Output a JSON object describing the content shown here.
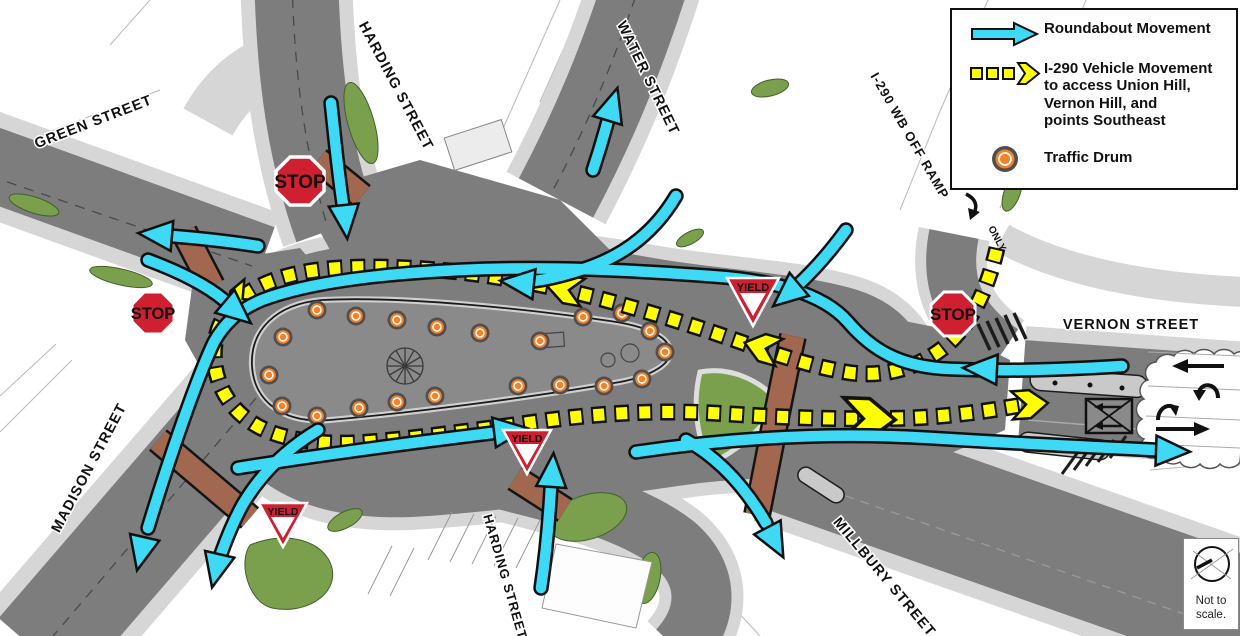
{
  "legend": {
    "items": [
      {
        "id": "roundabout-movement",
        "lines": [
          "Roundabout Movement"
        ]
      },
      {
        "id": "i290-movement",
        "lines": [
          "I-290 Vehicle Movement",
          "to access Union Hill,",
          "Vernon Hill, and",
          "points Southeast"
        ]
      },
      {
        "id": "traffic-drum",
        "lines": [
          "Traffic Drum"
        ]
      }
    ]
  },
  "street_labels": [
    {
      "id": "green-street",
      "text": "GREEN STREET"
    },
    {
      "id": "harding-street-top",
      "text": "HARDING STREET"
    },
    {
      "id": "water-street",
      "text": "WATER STREET"
    },
    {
      "id": "i290-wb-off-ramp",
      "text": "I-290 WB OFF RAMP"
    },
    {
      "id": "vernon-street",
      "text": "VERNON STREET"
    },
    {
      "id": "madison-street",
      "text": "MADISON STREET"
    },
    {
      "id": "harding-street-bottom",
      "text": "HARDING STREET"
    },
    {
      "id": "millbury-street",
      "text": "MILLBURY STREET"
    }
  ],
  "signs": {
    "stop_text": "STOP",
    "yield_text": "YIELD",
    "stop_count": 3,
    "yield_count": 3,
    "ramp_marking": "ONLY"
  },
  "note": {
    "lines": [
      "Not to",
      "scale."
    ]
  },
  "map": {
    "traffic_drum_count": 21
  },
  "colors": {
    "roundabout_arrow": "#3ED9F5",
    "i290_route_yellow": "#FFFF00",
    "traffic_drum_orange": "#F58025",
    "sign_red": "#CE2030",
    "road_gray": "#7D7D7D",
    "sidewalk_gray": "#D6D6D6",
    "grass_green": "#7AA04D",
    "brick_crosswalk": "#A2674F"
  }
}
